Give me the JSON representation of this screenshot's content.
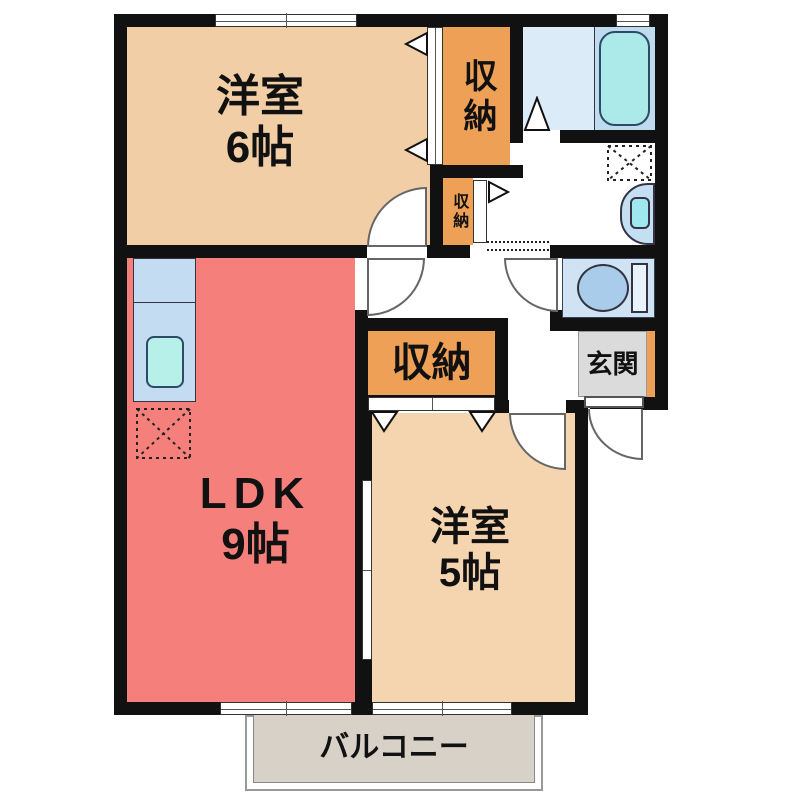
{
  "rooms": {
    "western6": {
      "name": "洋室",
      "size": "6帖"
    },
    "ldk": {
      "name": "LDK",
      "size": "9帖"
    },
    "western5": {
      "name": "洋室",
      "size": "5帖"
    },
    "closet_top": {
      "name": "収納"
    },
    "closet_small": {
      "name": "収納"
    },
    "closet_main": {
      "name": "収納"
    },
    "entrance": {
      "name": "玄関"
    },
    "balcony": {
      "name": "バルコニー"
    }
  },
  "fixtures": [
    "bathtub",
    "toilet",
    "washbasin",
    "kitchen-sink",
    "kitchen-counter",
    "washing-machine-space",
    "refrigerator-space"
  ],
  "colors": {
    "wall": "#111111",
    "western_room_6": "#F2CEA6",
    "western_room_5": "#F4D5B0",
    "ldk": "#F5807B",
    "closet": "#EFA057",
    "bathroom": "#DCEBF8",
    "bathtub_zone": "#BFDCEF",
    "bathtub": "#ACE9E9",
    "toilet_room": "#CFE3F4",
    "toilet_bowl": "#A9CCEA",
    "kitchen_counter": "#C3DCF2",
    "kitchen_sink": "#B7EFE9",
    "washbasin": "#C4DFF2",
    "washbasin_bowl": "#9FE8EF",
    "entrance_floor": "#DBDBDB",
    "entrance_step": "#EFA057",
    "balcony": "#D8D1C8"
  }
}
